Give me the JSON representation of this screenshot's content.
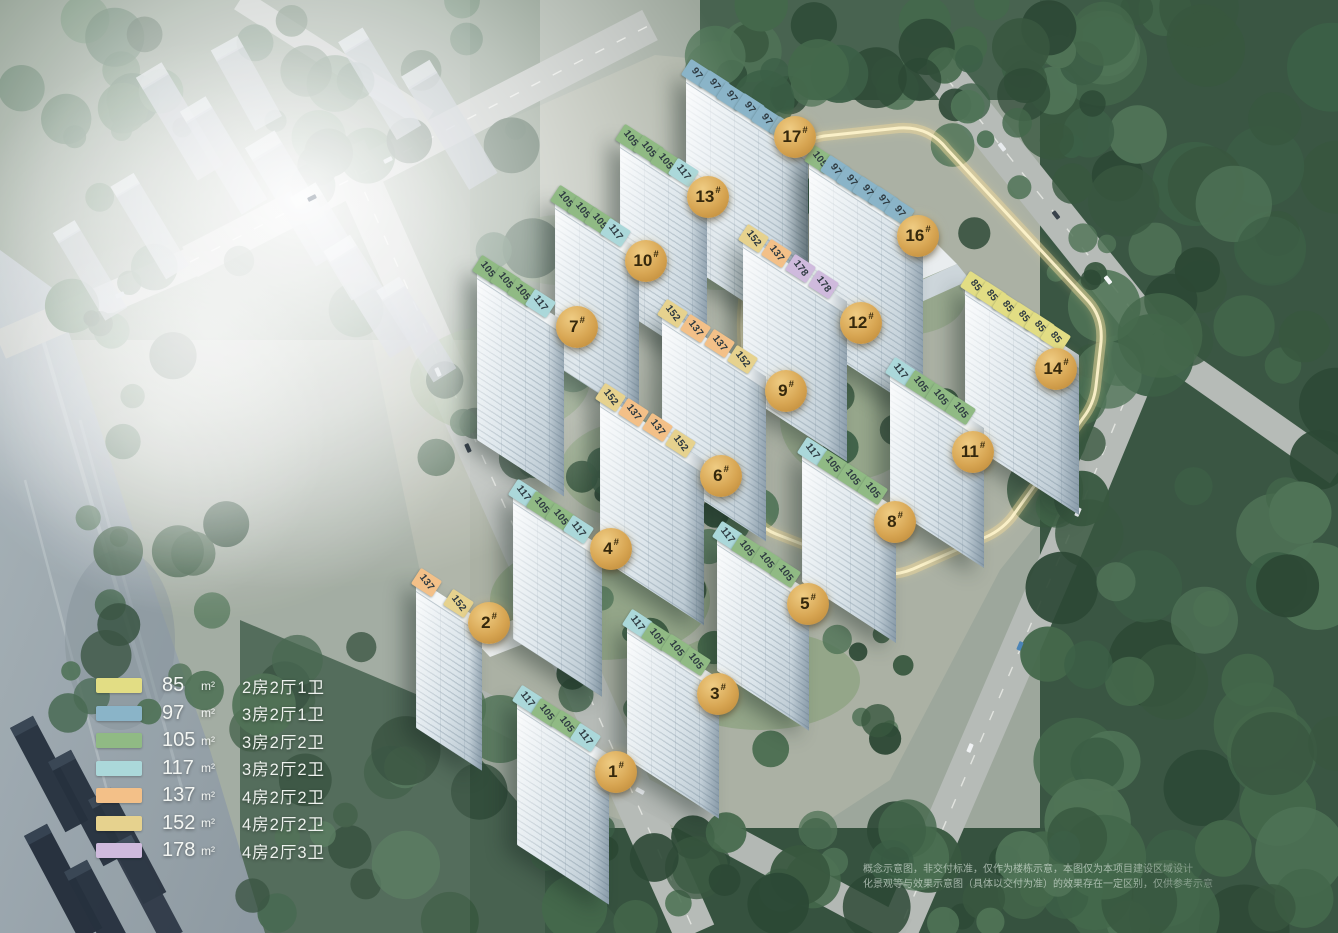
{
  "legend": {
    "items": [
      {
        "area": "85",
        "unit": "m²",
        "layout": "2房2厅1卫",
        "color": "#e2dd84"
      },
      {
        "area": "97",
        "unit": "m²",
        "layout": "3房2厅1卫",
        "color": "#8ab4c8"
      },
      {
        "area": "105",
        "unit": "m²",
        "layout": "3房2厅2卫",
        "color": "#90ba84"
      },
      {
        "area": "117",
        "unit": "m²",
        "layout": "3房2厅2卫",
        "color": "#abd8da"
      },
      {
        "area": "137",
        "unit": "m²",
        "layout": "4房2厅2卫",
        "color": "#f3c088"
      },
      {
        "area": "152",
        "unit": "m²",
        "layout": "4房2厅2卫",
        "color": "#e6d28e"
      },
      {
        "area": "178",
        "unit": "m²",
        "layout": "4房2厅3卫",
        "color": "#cfbadd"
      }
    ]
  },
  "buildings": [
    {
      "id": "1",
      "badge": "1#",
      "chips": [
        "117",
        "105",
        "105",
        "117"
      ],
      "geom": {
        "x": 527,
        "y": 700,
        "s": 23,
        "h": 150,
        "bx": 616,
        "by": 772
      }
    },
    {
      "id": "2",
      "badge": "2#",
      "chips": [
        "137",
        "152"
      ],
      "geom": {
        "x": 426,
        "y": 583,
        "s": 38,
        "h": 150,
        "bx": 489,
        "by": 623
      }
    },
    {
      "id": "3",
      "badge": "3#",
      "chips": [
        "117",
        "105",
        "105",
        "105"
      ],
      "geom": {
        "x": 637,
        "y": 624,
        "s": 23,
        "h": 140,
        "bx": 718,
        "by": 694
      }
    },
    {
      "id": "4",
      "badge": "4#",
      "chips": [
        "117",
        "105",
        "105",
        "117"
      ],
      "geom": {
        "x": 523,
        "y": 494,
        "s": 22,
        "h": 150,
        "bx": 611,
        "by": 549
      }
    },
    {
      "id": "5",
      "badge": "5#",
      "chips": [
        "117",
        "105",
        "105",
        "105"
      ],
      "geom": {
        "x": 727,
        "y": 536,
        "s": 23,
        "h": 140,
        "bx": 808,
        "by": 604
      }
    },
    {
      "id": "6",
      "badge": "6#",
      "chips": [
        "152",
        "137",
        "137",
        "152"
      ],
      "geom": {
        "x": 610,
        "y": 398,
        "s": 28,
        "h": 165,
        "bx": 721,
        "by": 476
      }
    },
    {
      "id": "7",
      "badge": "7#",
      "chips": [
        "105",
        "105",
        "105",
        "117"
      ],
      "geom": {
        "x": 487,
        "y": 270,
        "s": 21,
        "h": 175,
        "bx": 577,
        "by": 327
      }
    },
    {
      "id": "8",
      "badge": "8#",
      "chips": [
        "117",
        "105",
        "105",
        "105"
      ],
      "geom": {
        "x": 812,
        "y": 452,
        "s": 24,
        "h": 135,
        "bx": 895,
        "by": 522
      }
    },
    {
      "id": "9",
      "badge": "9#",
      "chips": [
        "152",
        "137",
        "137",
        "152"
      ],
      "geom": {
        "x": 672,
        "y": 314,
        "s": 28,
        "h": 165,
        "bx": 786,
        "by": 391
      }
    },
    {
      "id": "10",
      "badge": "10#",
      "chips": [
        "105",
        "105",
        "105",
        "117"
      ],
      "geom": {
        "x": 565,
        "y": 200,
        "s": 20,
        "h": 170,
        "bx": 646,
        "by": 261
      }
    },
    {
      "id": "11",
      "badge": "11#",
      "chips": [
        "117",
        "105",
        "105",
        "105"
      ],
      "geom": {
        "x": 900,
        "y": 372,
        "s": 24,
        "h": 140,
        "bx": 973,
        "by": 452
      }
    },
    {
      "id": "12",
      "badge": "12#",
      "chips": [
        "152",
        "137",
        "178",
        "178"
      ],
      "geom": {
        "x": 753,
        "y": 239,
        "s": 28,
        "h": 160,
        "bx": 861,
        "by": 323
      }
    },
    {
      "id": "13",
      "badge": "13#",
      "chips": [
        "105",
        "105",
        "105",
        "117"
      ],
      "geom": {
        "x": 630,
        "y": 139,
        "s": 21,
        "h": 175,
        "bx": 708,
        "by": 197
      }
    },
    {
      "id": "14",
      "badge": "14#",
      "chips": [
        "85",
        "85",
        "85",
        "85",
        "85",
        "85"
      ],
      "geom": {
        "x": 975,
        "y": 286,
        "s": 19,
        "h": 160,
        "bx": 1056,
        "by": 369
      }
    },
    {
      "id": "16",
      "badge": "16#",
      "chips": [
        "105",
        "97",
        "97",
        "97",
        "97",
        "97"
      ],
      "geom": {
        "x": 819,
        "y": 160,
        "s": 19,
        "h": 185,
        "bx": 918,
        "by": 236
      }
    },
    {
      "id": "17",
      "badge": "17#",
      "chips": [
        "97",
        "97",
        "97",
        "97",
        "97",
        "97"
      ],
      "geom": {
        "x": 696,
        "y": 74,
        "s": 21,
        "h": 195,
        "bx": 795,
        "by": 137
      }
    }
  ],
  "disclaimer": {
    "line1": "概念示意图，非交付标准，仅作为楼栋示意，本图仅为本项目建设区域设计",
    "line2": "化景观等与效果示意图（具体以交付为准）的效果存在一定区别，仅供参考示意"
  }
}
